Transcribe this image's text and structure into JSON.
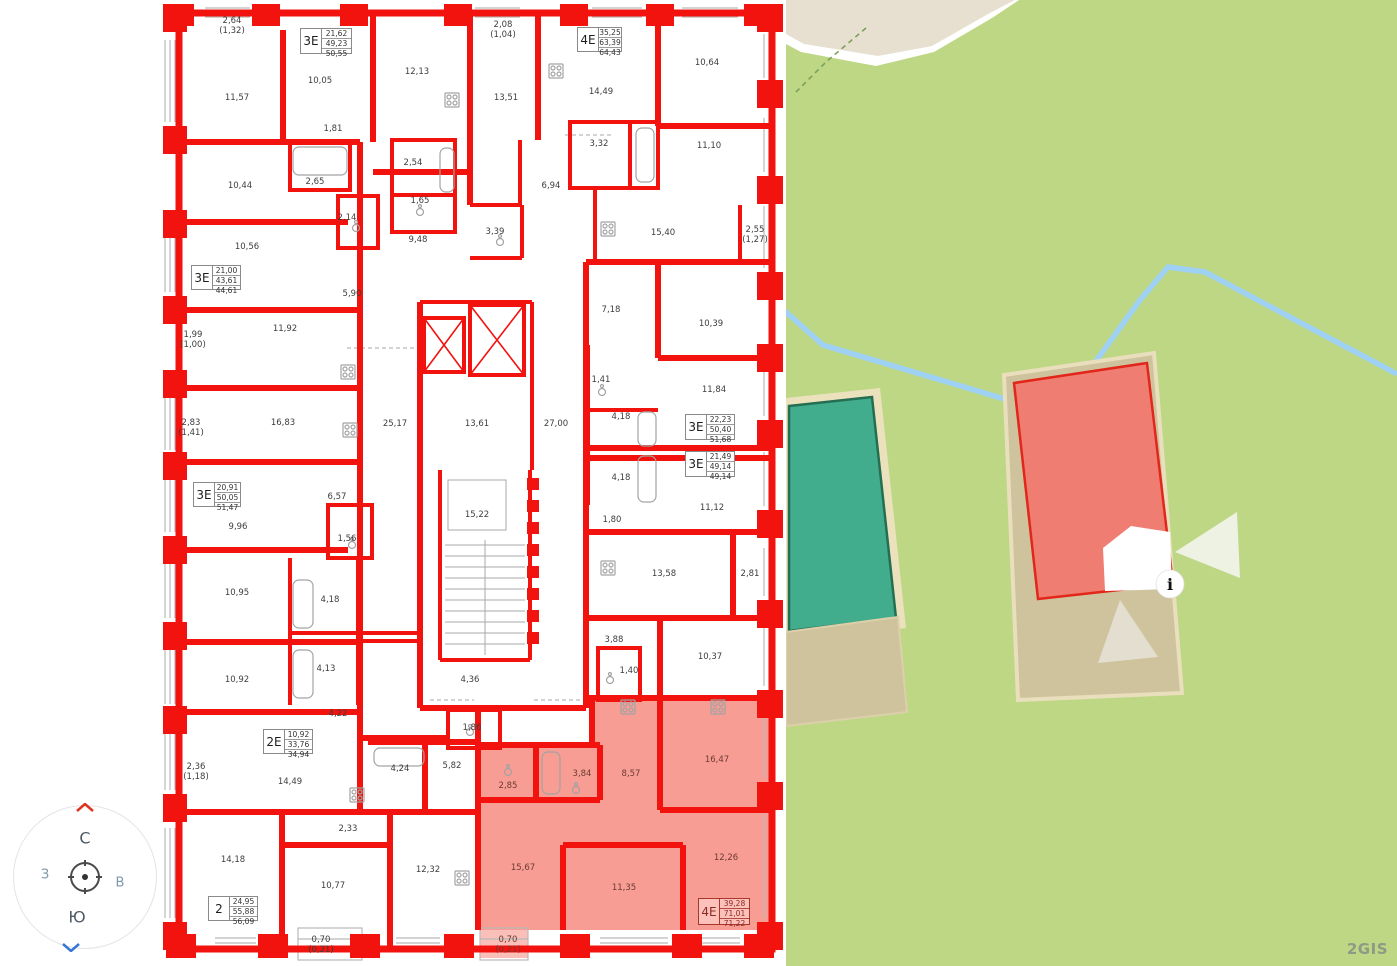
{
  "colors": {
    "wall_red": "#f2130e",
    "highlight_pink": "#f79d93",
    "map_green": "#bdd785",
    "map_road_beige": "#e7e0d1",
    "building_tan": "#cfc39e",
    "building_teal": "#42ad8d",
    "building_teal_border": "#256e52",
    "building_red": "#ef7d72",
    "building_red_border": "#e2261a",
    "stream_blue": "#9ed1f4",
    "label_color": "#3d3d3d",
    "pink_label_color": "#6b3a35"
  },
  "compass": {
    "north": "С",
    "south": "Ю",
    "west": "З",
    "east": "В"
  },
  "map": {
    "watermark": "2GIS",
    "info_marker_label": "i"
  },
  "floorplan": {
    "apartment_boxes": [
      {
        "type": "3Е",
        "values": [
          "21,62",
          "49,23",
          "50,55"
        ],
        "x": 300,
        "y": 28,
        "w": 52,
        "h": 26
      },
      {
        "type": "4Е",
        "values": [
          "35,25",
          "63,39",
          "64,43"
        ],
        "x": 577,
        "y": 27,
        "w": 45,
        "h": 25
      },
      {
        "type": "3Е",
        "values": [
          "21,00",
          "43,61",
          "44,61"
        ],
        "x": 191,
        "y": 265,
        "w": 50,
        "h": 25
      },
      {
        "type": "3Е",
        "values": [
          "22,23",
          "50,40",
          "51,68"
        ],
        "x": 685,
        "y": 414,
        "w": 50,
        "h": 26
      },
      {
        "type": "3Е",
        "values": [
          "21,49",
          "49,14",
          "49,14"
        ],
        "x": 685,
        "y": 451,
        "w": 50,
        "h": 26
      },
      {
        "type": "3Е",
        "values": [
          "20,91",
          "50,05",
          "51,47"
        ],
        "x": 193,
        "y": 482,
        "w": 48,
        "h": 25
      },
      {
        "type": "2Е",
        "values": [
          "10,92",
          "33,76",
          "34,94"
        ],
        "x": 263,
        "y": 729,
        "w": 50,
        "h": 25
      },
      {
        "type": "2",
        "values": [
          "24,95",
          "55,88",
          "56,09"
        ],
        "x": 208,
        "y": 896,
        "w": 50,
        "h": 25
      },
      {
        "type": "4Е",
        "values": [
          "39,28",
          "71,01",
          "71,22"
        ],
        "x": 698,
        "y": 898,
        "w": 52,
        "h": 27,
        "pink": true
      }
    ],
    "room_labels": [
      {
        "t": "2,64\n(1,32)",
        "x": 232,
        "y": 26
      },
      {
        "t": "10,05",
        "x": 320,
        "y": 81
      },
      {
        "t": "12,13",
        "x": 417,
        "y": 72
      },
      {
        "t": "2,08\n(1,04)",
        "x": 503,
        "y": 30
      },
      {
        "t": "14,49",
        "x": 601,
        "y": 92
      },
      {
        "t": "10,64",
        "x": 707,
        "y": 63
      },
      {
        "t": "11,57",
        "x": 237,
        "y": 98
      },
      {
        "t": "13,51",
        "x": 506,
        "y": 98
      },
      {
        "t": "1,81",
        "x": 333,
        "y": 129
      },
      {
        "t": "3,32",
        "x": 599,
        "y": 144
      },
      {
        "t": "11,10",
        "x": 709,
        "y": 146
      },
      {
        "t": "2,54",
        "x": 413,
        "y": 163
      },
      {
        "t": "2,65",
        "x": 315,
        "y": 182
      },
      {
        "t": "10,44",
        "x": 240,
        "y": 186
      },
      {
        "t": "6,94",
        "x": 551,
        "y": 186
      },
      {
        "t": "1,65",
        "x": 420,
        "y": 201
      },
      {
        "t": "2,14",
        "x": 347,
        "y": 218
      },
      {
        "t": "9,48",
        "x": 418,
        "y": 240
      },
      {
        "t": "3,39",
        "x": 495,
        "y": 232
      },
      {
        "t": "15,40",
        "x": 663,
        "y": 233
      },
      {
        "t": "2,55\n(1,27)",
        "x": 755,
        "y": 235
      },
      {
        "t": "10,56",
        "x": 247,
        "y": 247
      },
      {
        "t": "5,90",
        "x": 352,
        "y": 294
      },
      {
        "t": "7,18",
        "x": 611,
        "y": 310
      },
      {
        "t": "10,39",
        "x": 711,
        "y": 324
      },
      {
        "t": "1,99\n(1,00)",
        "x": 193,
        "y": 340
      },
      {
        "t": "11,92",
        "x": 285,
        "y": 329
      },
      {
        "t": "1,41",
        "x": 601,
        "y": 380
      },
      {
        "t": "11,84",
        "x": 714,
        "y": 390
      },
      {
        "t": "2,83\n(1,41)",
        "x": 191,
        "y": 428
      },
      {
        "t": "16,83",
        "x": 283,
        "y": 423
      },
      {
        "t": "25,17",
        "x": 395,
        "y": 424
      },
      {
        "t": "13,61",
        "x": 477,
        "y": 424
      },
      {
        "t": "27,00",
        "x": 556,
        "y": 424
      },
      {
        "t": "4,18",
        "x": 621,
        "y": 417
      },
      {
        "t": "4,18",
        "x": 621,
        "y": 478
      },
      {
        "t": "11,12",
        "x": 712,
        "y": 508
      },
      {
        "t": "6,57",
        "x": 337,
        "y": 497
      },
      {
        "t": "9,96",
        "x": 238,
        "y": 527
      },
      {
        "t": "1,56",
        "x": 347,
        "y": 539
      },
      {
        "t": "15,22",
        "x": 477,
        "y": 515
      },
      {
        "t": "1,80",
        "x": 612,
        "y": 520
      },
      {
        "t": "10,95",
        "x": 237,
        "y": 593
      },
      {
        "t": "4,18",
        "x": 330,
        "y": 600
      },
      {
        "t": "13,58",
        "x": 664,
        "y": 574
      },
      {
        "t": "2,81",
        "x": 750,
        "y": 574
      },
      {
        "t": "4,13",
        "x": 326,
        "y": 669
      },
      {
        "t": "3,88",
        "x": 614,
        "y": 640
      },
      {
        "t": "10,37",
        "x": 710,
        "y": 657
      },
      {
        "t": "10,92",
        "x": 237,
        "y": 680
      },
      {
        "t": "1,40",
        "x": 629,
        "y": 671
      },
      {
        "t": "4,36",
        "x": 470,
        "y": 680
      },
      {
        "t": "4,22",
        "x": 338,
        "y": 714
      },
      {
        "t": "1,86",
        "x": 472,
        "y": 728
      },
      {
        "t": "16,47",
        "x": 717,
        "y": 760,
        "p": true
      },
      {
        "t": "2,36\n(1,18)",
        "x": 196,
        "y": 772
      },
      {
        "t": "14,49",
        "x": 290,
        "y": 782
      },
      {
        "t": "4,24",
        "x": 400,
        "y": 769
      },
      {
        "t": "5,82",
        "x": 452,
        "y": 766
      },
      {
        "t": "2,85",
        "x": 508,
        "y": 786,
        "p": true
      },
      {
        "t": "3,84",
        "x": 582,
        "y": 774,
        "p": true
      },
      {
        "t": "8,57",
        "x": 631,
        "y": 774,
        "p": true
      },
      {
        "t": "2,33",
        "x": 348,
        "y": 829
      },
      {
        "t": "14,18",
        "x": 233,
        "y": 860
      },
      {
        "t": "10,77",
        "x": 333,
        "y": 886
      },
      {
        "t": "12,32",
        "x": 428,
        "y": 870
      },
      {
        "t": "15,67",
        "x": 523,
        "y": 868,
        "p": true
      },
      {
        "t": "12,26",
        "x": 726,
        "y": 858,
        "p": true
      },
      {
        "t": "11,35",
        "x": 624,
        "y": 888,
        "p": true
      },
      {
        "t": "0,70\n(0,21)",
        "x": 321,
        "y": 945
      },
      {
        "t": "0,70\n(0,21)",
        "x": 508,
        "y": 945,
        "p": true
      }
    ]
  }
}
